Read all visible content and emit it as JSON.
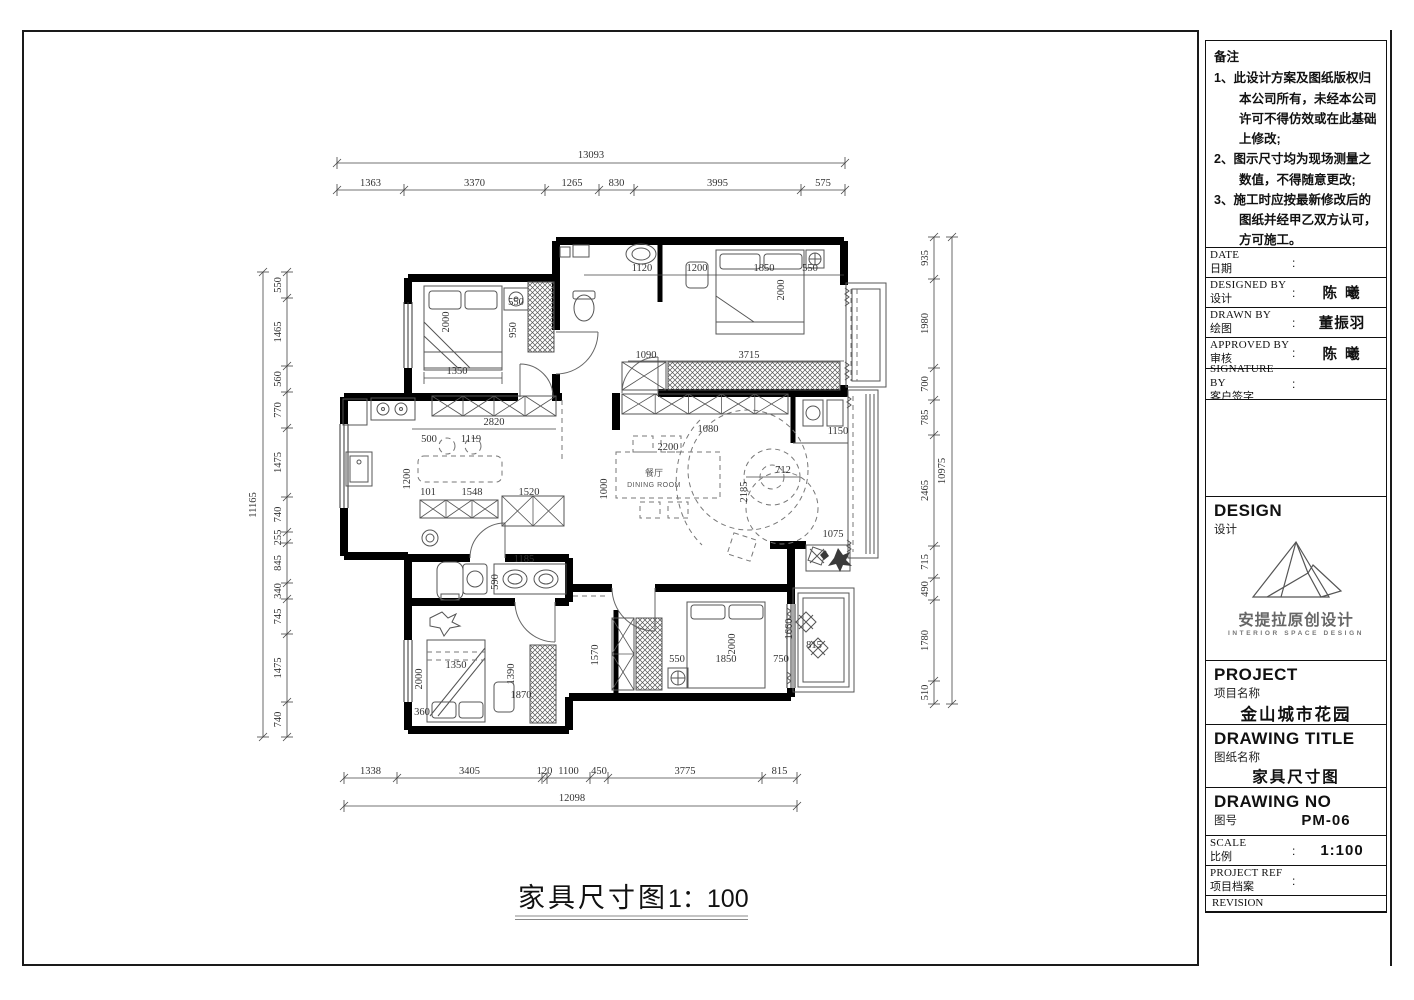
{
  "punct": {
    "colon": ":"
  },
  "notes": {
    "title": "备注",
    "items": [
      "1、此设计方案及图纸版权归本公司所有，未经本公司许可不得仿效或在此基础上修改;",
      "2、图示尺寸均为现场测量之数值，不得随意更改;",
      "3、施工时应按最新修改后的图纸并经甲乙双方认可，方可施工。",
      "4、施工单位有责任在现场核实所有尺寸，发现不符之处以现场实际尺寸为准。"
    ]
  },
  "title_block": {
    "date": {
      "en": "DATE",
      "zh": "日期",
      "value": ""
    },
    "designed": {
      "en": "DESIGNED BY",
      "zh": "设计",
      "value": "陈 曦"
    },
    "drawn": {
      "en": "DRAWN BY",
      "zh": "绘图",
      "value": "董振羽"
    },
    "approved": {
      "en": "APPROVED BY",
      "zh": "审核",
      "value": "陈 曦"
    },
    "signature": {
      "en": "SIGNATURE BY",
      "zh": "客户签字",
      "value": ""
    }
  },
  "design_section": {
    "en": "DESIGN",
    "zh": "设计",
    "logo_cn": "安提拉原创设计",
    "logo_en": "INTERIOR SPACE DESIGN"
  },
  "project": {
    "en": "PROJECT",
    "zh": "项目名称",
    "value": "金山城市花园"
  },
  "drawing_title": {
    "en": "DRAWING  TITLE",
    "zh": "图纸名称",
    "value": "家具尺寸图"
  },
  "drawing_no": {
    "en": "DRAWING NO",
    "zh": "图号",
    "value": "PM-06"
  },
  "scale": {
    "en": "SCALE",
    "zh": "比例",
    "value": "1:100"
  },
  "project_ref": {
    "en": "PROJECT REF",
    "zh": "项目档案"
  },
  "revision": {
    "en": "REVISION"
  },
  "plan_title": {
    "text": "家具尺寸图",
    "scale": "1：100"
  },
  "rooms": {
    "dining_zh": "餐厅",
    "dining_en": "DINING ROOM"
  },
  "dims": {
    "top": {
      "total": "13093",
      "segments": [
        "1363",
        "3370",
        "1265",
        "830",
        "3995",
        "575"
      ]
    },
    "bottom": {
      "total": "12098",
      "segments": [
        "1338",
        "3405",
        "120",
        "1100",
        "450",
        "3775",
        "815"
      ]
    },
    "left": {
      "total": "11165",
      "segments": [
        "550",
        "1465",
        "560",
        "770",
        "1475",
        "740",
        "255",
        "845",
        "340",
        "745",
        "1475",
        "740"
      ]
    },
    "right": {
      "total": "10975",
      "segments": [
        "935",
        "1980",
        "700",
        "785",
        "2465",
        "715",
        "490",
        "1780",
        "510"
      ]
    },
    "interior": [
      "1350",
      "2000",
      "950",
      "550",
      "1120",
      "1200",
      "1850",
      "550",
      "2000",
      "3715",
      "1090",
      "1080",
      "1150",
      "2820",
      "500",
      "1119",
      "1200",
      "101",
      "1548",
      "1520",
      "2200",
      "1000",
      "2185",
      "712",
      "1075",
      "1185",
      "590",
      "1350",
      "2000",
      "1390",
      "1870",
      "360",
      "1570",
      "550",
      "1850",
      "750",
      "2000",
      "1660",
      "815"
    ]
  }
}
